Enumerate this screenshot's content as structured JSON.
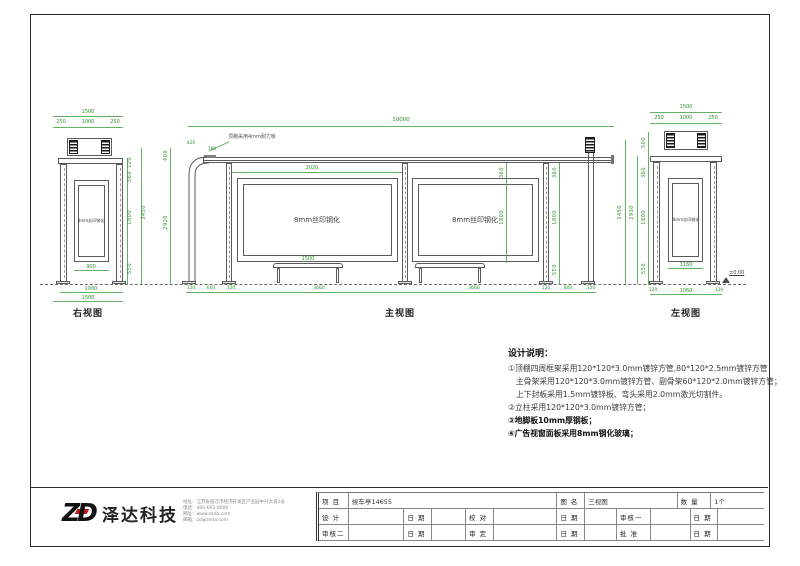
{
  "views": {
    "right_view_label": "右视图",
    "front_view_label": "主视图",
    "left_view_label": "左视图"
  },
  "panels": {
    "silkscreen": "8mm丝印钢化"
  },
  "annotations": {
    "roof_note": "顶棚采用4mm耐力板",
    "ground_level": "±0.00"
  },
  "dims": {
    "right_view": {
      "w1500": "1500",
      "w250": "250",
      "w1000": "1000",
      "v120": "120",
      "v560": "560",
      "v1800": "1800",
      "v550": "550",
      "v3450": "3450",
      "b900": "900",
      "b1000": "1000",
      "b1500": "1500"
    },
    "front_view": {
      "w10000": "10000",
      "d420": "420",
      "d780": "780",
      "d2020": "2020",
      "bench": "1500",
      "b120": "120",
      "b600": "600",
      "b3660": "3660",
      "b800": "800",
      "v360": "360",
      "v1800": "1800",
      "v550": "550",
      "v400": "400",
      "v2920": "2920",
      "v3450": "3450"
    },
    "left_view": {
      "w1500": "1500",
      "w250": "250",
      "w1000": "1000",
      "v500": "500",
      "v360": "360",
      "v1800": "1800",
      "v550": "550",
      "v2930": "2930",
      "b1160": "1160",
      "b1060": "1060",
      "b120": "120"
    }
  },
  "notes": {
    "title": "设计说明：",
    "items": [
      "①顶棚四周框架采用120*120*3.0mm镀锌方管,80*120*2.5mm镀锌方管，",
      "主骨架采用120*120*3.0mm镀锌方管、副骨架60*120*2.0mm镀锌方管；",
      "上下封板采用1.5mm镀锌板、弯头采用2.0mm激光切割件。",
      "②立柱采用120*120*3.0mm镀锌方管；",
      "③地脚板10mm厚钢板；",
      "④广告视窗面板采用8mm钢化玻璃；"
    ]
  },
  "titleblock": {
    "logo": "ZD",
    "company_name": "泽达科技",
    "company_info": [
      "地址：江苏省宿迁市经济开发区产业园中兴大道2号",
      "电话：400-662-0000",
      "网址：www.zeda.com",
      "邮箱：zd@zeda.com"
    ],
    "labels": {
      "project": "项 目",
      "drawing": "图 名",
      "qty": "数 量",
      "design": "设 计",
      "date": "日 期",
      "proof": "校 对",
      "review2": "审核二",
      "approve": "审 定",
      "review1": "审核一",
      "ratify": "批 准"
    },
    "values": {
      "project": "候车亭14655",
      "drawing": "三视图",
      "qty": "1个"
    }
  }
}
